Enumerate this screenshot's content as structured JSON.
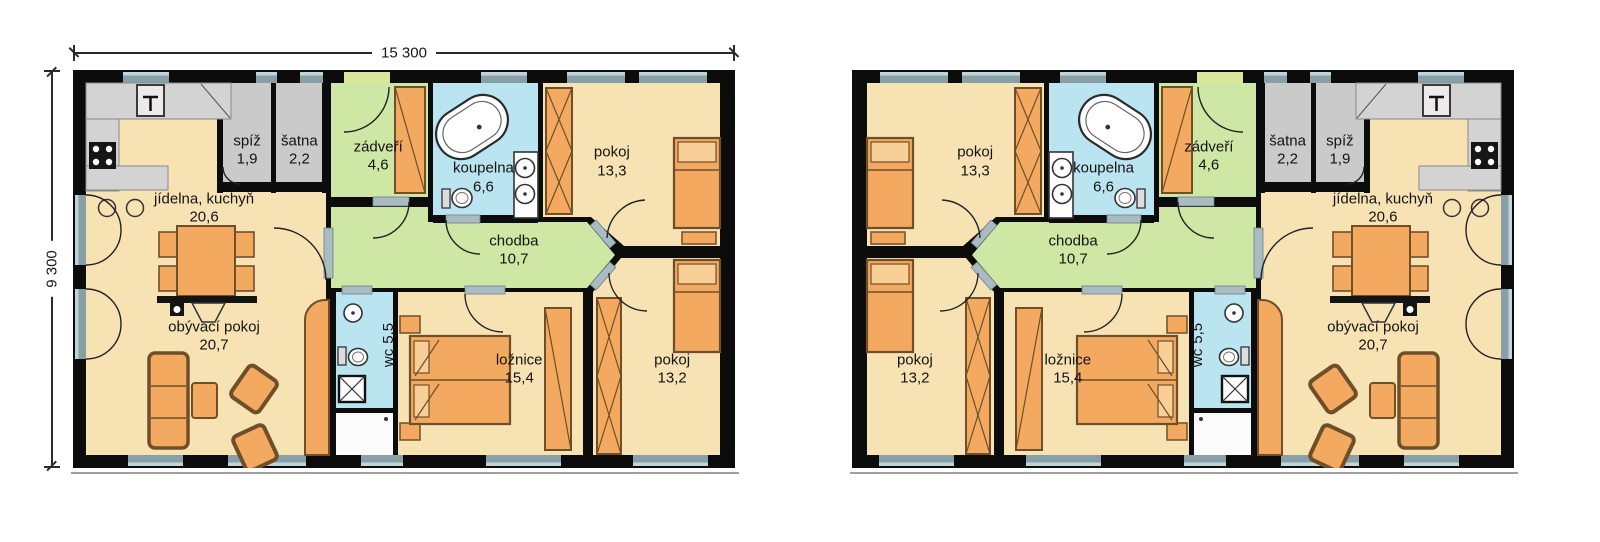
{
  "drawing": {
    "type": "floor-plan",
    "background": "#ffffff",
    "wall_color": "#0c0c0c",
    "room_colors": {
      "living_tan": "#f7e2b4",
      "hall_green": "#cfe7a5",
      "bath_blue": "#b9e4f0",
      "storage_gray": "#cacaca",
      "furniture_orange": "#f3a95f",
      "furniture_border": "#6f4f2a",
      "window_glass": "#87a0a8",
      "entry_door": "#d9e79b",
      "door_sill": "#a9bcc2"
    }
  },
  "dimensions": {
    "width": "15 300",
    "height": "9 300"
  },
  "plans": [
    {
      "id": "plan-left",
      "mirrored": false
    },
    {
      "id": "plan-right",
      "mirrored": true
    }
  ],
  "rooms": [
    {
      "key": "jidelna-kuchyn",
      "name": "jídelna, kuchyň",
      "area": "20,6",
      "x": 19.8,
      "y": 34.8,
      "vertical": false
    },
    {
      "key": "spiz",
      "name": "spíž",
      "area": "1,9",
      "x": 26.3,
      "y": 20.3,
      "vertical": false
    },
    {
      "key": "satna",
      "name": "šatna",
      "area": "2,2",
      "x": 34.2,
      "y": 20.3,
      "vertical": false
    },
    {
      "key": "zadveri",
      "name": "zádveří",
      "area": "4,6",
      "x": 46.1,
      "y": 21.8,
      "vertical": false
    },
    {
      "key": "koupelna",
      "name": "koupelna",
      "area": "6,6",
      "x": 62.0,
      "y": 27.2,
      "vertical": false
    },
    {
      "key": "pokoj-1",
      "name": "pokoj",
      "area": "13,3",
      "x": 81.4,
      "y": 23.2,
      "vertical": false
    },
    {
      "key": "chodba",
      "name": "chodba",
      "area": "10,7",
      "x": 66.6,
      "y": 45.5,
      "vertical": false
    },
    {
      "key": "wc",
      "name": "wc",
      "area": "5,5",
      "x": 47.8,
      "y": 69.2,
      "vertical": true
    },
    {
      "key": "loznice",
      "name": "ložnice",
      "area": "15,4",
      "x": 67.4,
      "y": 75.4,
      "vertical": false
    },
    {
      "key": "pokoj-2",
      "name": "pokoj",
      "area": "13,2",
      "x": 90.5,
      "y": 75.4,
      "vertical": false
    },
    {
      "key": "obyvaci-pokoj",
      "name": "obývací pokoj",
      "area": "20,7",
      "x": 21.3,
      "y": 67.0,
      "vertical": false
    }
  ]
}
